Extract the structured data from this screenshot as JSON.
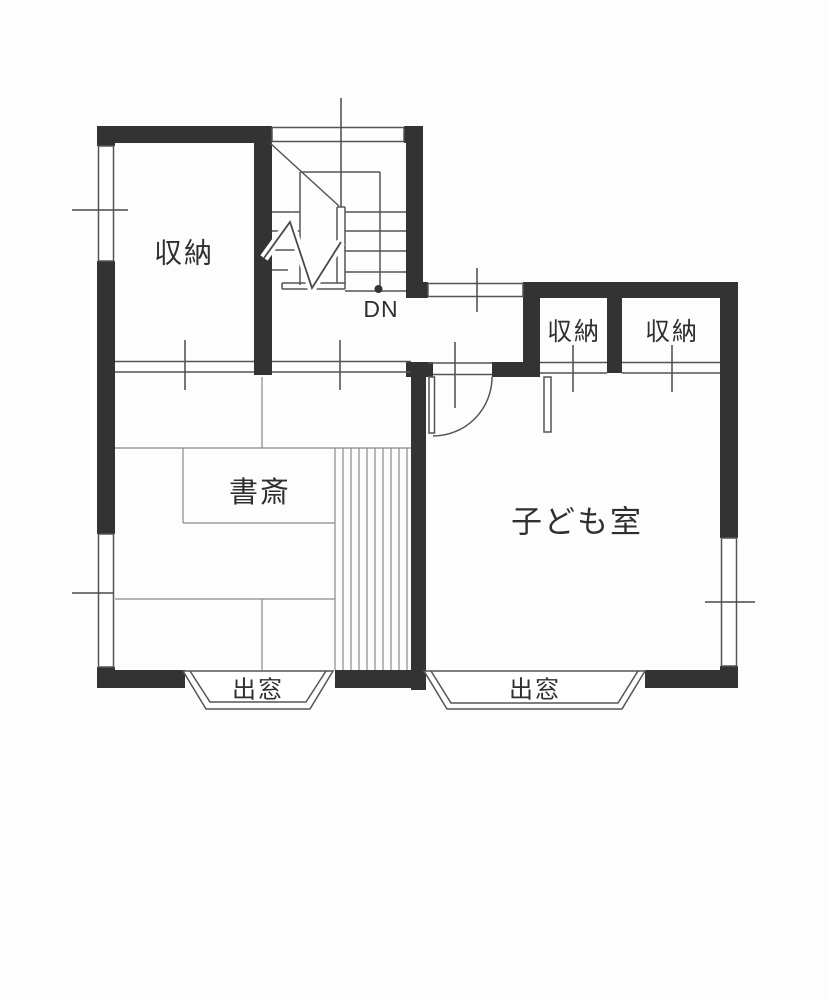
{
  "floorplan": {
    "type": "japanese-floor-plan",
    "colors": {
      "wall": "#333333",
      "line": "#555555",
      "thin_line": "#8a8a8a",
      "background": "#fdfdfd",
      "text": "#2f2f2f"
    },
    "labels": {
      "storage_nw": "収納",
      "storage_closet_left": "収納",
      "storage_closet_right": "収納",
      "study": "書斎",
      "children_room": "子ども室",
      "bay_window_left": "出窓",
      "bay_window_right": "出窓",
      "stairs_down": "DN"
    },
    "rooms": [
      {
        "name": "storage-room-northwest",
        "label": "収納"
      },
      {
        "name": "staircase",
        "label": "DN"
      },
      {
        "name": "closet-east-1",
        "label": "収納"
      },
      {
        "name": "closet-east-2",
        "label": "収納"
      },
      {
        "name": "study-tatami-room",
        "label": "書斎"
      },
      {
        "name": "children-room",
        "label": "子ども室"
      },
      {
        "name": "bay-window-south-left",
        "label": "出窓"
      },
      {
        "name": "bay-window-south-right",
        "label": "出窓"
      }
    ]
  }
}
